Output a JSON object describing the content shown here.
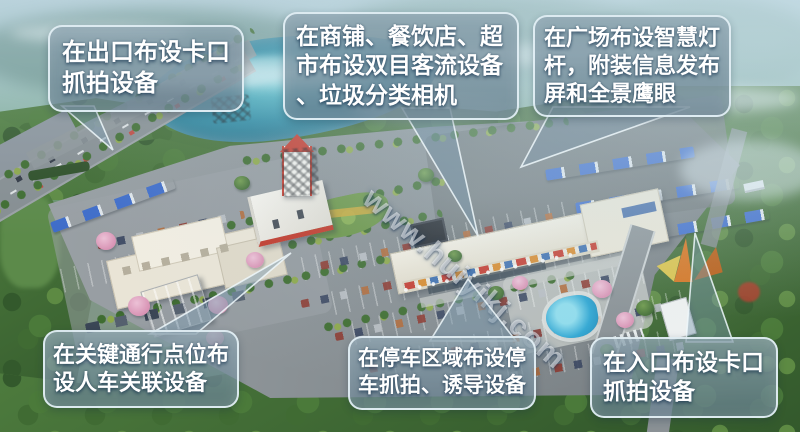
{
  "watermark": {
    "text": "www.huiyikj.com"
  },
  "callouts": [
    {
      "id": "exit-capture",
      "lines": [
        "在出口布设卡口",
        "抓拍设备"
      ]
    },
    {
      "id": "shop-flow",
      "lines": [
        "在商铺、餐饮店、超",
        "市布设双目客流设备",
        "、垃圾分类相机"
      ]
    },
    {
      "id": "plaza-smart-pole",
      "lines": [
        "在广场布设智慧灯",
        "杆，附装信息发布",
        "屏和全景鹰眼"
      ]
    },
    {
      "id": "key-points",
      "lines": [
        "在关键通行点位布",
        "设人车关联设备"
      ]
    },
    {
      "id": "parking-capture",
      "lines": [
        "在停车区域布设停",
        "车抓拍、诱导设备"
      ]
    },
    {
      "id": "entrance-capture",
      "lines": [
        "在入口布设卡口",
        "抓拍设备"
      ]
    }
  ],
  "colors": {
    "callout_fill": "#7d95a5",
    "callout_border": "#e8f4f9",
    "callout_text": "#ffffff",
    "watermark_text": "#ffffff",
    "asphalt": "#878e92",
    "forest": "#4e7c3e",
    "lake": "#2e8aa2",
    "truck_blue": "#3e6cc9",
    "gas_station_red": "#c0392b",
    "sculpture_orange": "#d4731f"
  }
}
